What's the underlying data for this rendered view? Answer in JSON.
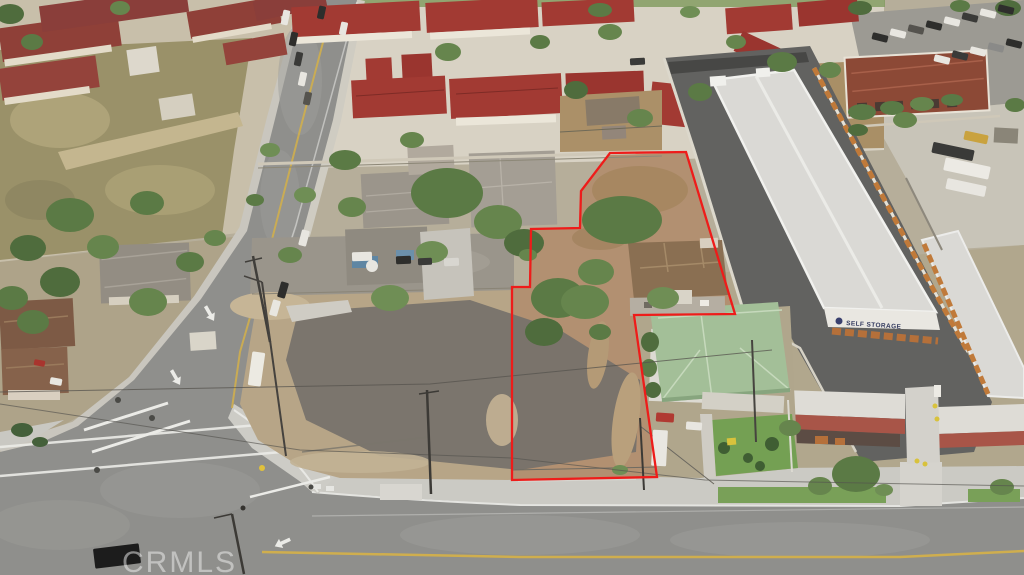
{
  "photo": {
    "description": "Aerial drone photo of vacant land listing with outlined parcel",
    "watermark": {
      "text": "CRMLS"
    },
    "storage_sign": {
      "text": "SELF STORAGE"
    }
  },
  "parcel": {
    "boundary_points": [
      [
        610,
        153
      ],
      [
        686,
        152
      ],
      [
        735,
        314
      ],
      [
        634,
        315
      ],
      [
        657,
        477
      ],
      [
        512,
        480
      ],
      [
        512,
        287
      ],
      [
        530,
        287
      ],
      [
        531,
        229
      ],
      [
        580,
        228
      ],
      [
        581,
        191
      ]
    ]
  },
  "colors": {
    "boundary_red": "#ee1c1a",
    "watermark_gray": "rgba(238,238,238,0.55)",
    "sign_text": "#353c60",
    "storage_door_orange": "#c07a3a",
    "condo_roof_red": "#a23a33",
    "green_roof": "#a3bf98"
  }
}
